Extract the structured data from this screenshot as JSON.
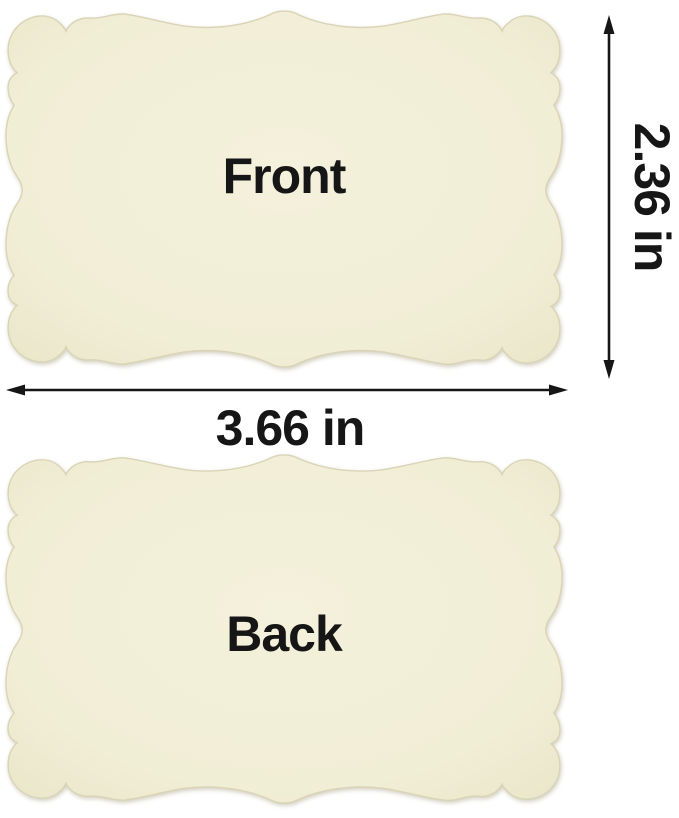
{
  "cards": {
    "front_label": "Front",
    "back_label": "Back"
  },
  "dimensions": {
    "height": "2.36 in",
    "width": "3.66 in"
  },
  "colors": {
    "card_fill": "#F1EED6",
    "card_fill_light": "#F4F1DC",
    "card_fill_edge": "#E8E4C7",
    "card_stroke": "#D9D4B6",
    "ink": "#161616",
    "background": "#FFFFFF"
  }
}
